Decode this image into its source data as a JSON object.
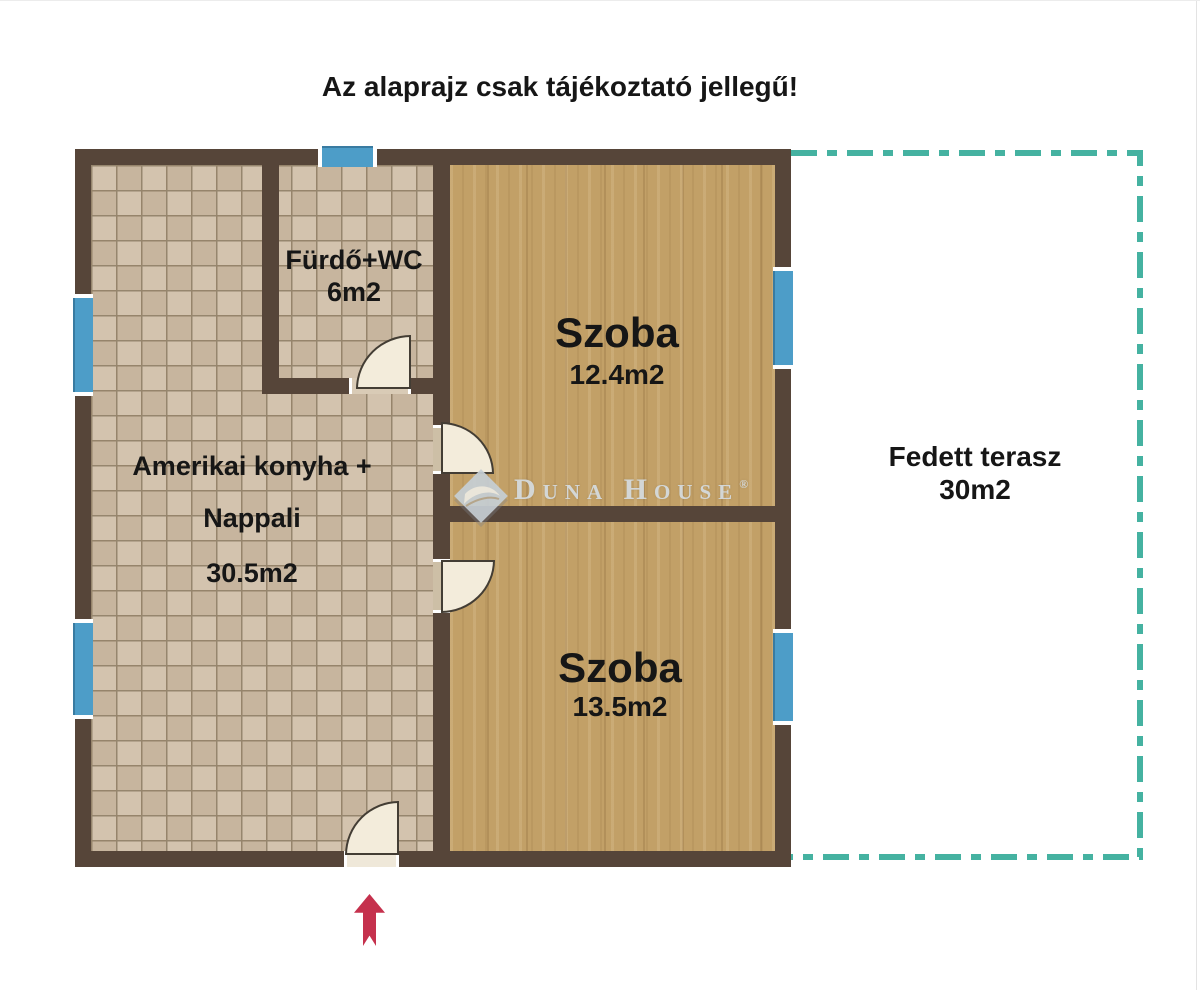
{
  "title": "Az alaprajz csak tájékoztató jellegű!",
  "rooms": {
    "bathroom": {
      "name": "Fürdő+WC",
      "area": "6m2"
    },
    "bedroom1": {
      "name": "Szoba",
      "area": "12.4m2"
    },
    "living": {
      "name_line1": "Amerikai konyha +",
      "name_line2": "Nappali",
      "area": "30.5m2"
    },
    "bedroom2": {
      "name": "Szoba",
      "area": "13.5m2"
    },
    "terrace": {
      "name": "Fedett terasz",
      "area": "30m2"
    }
  },
  "watermark": {
    "brand": "Duna House",
    "registered": "®"
  },
  "colors": {
    "wall": "#564539",
    "window": "#4d9dc8",
    "terrace_dash": "#45b2a1",
    "entry_arrow": "#c5314d",
    "tile_floor": "#d3c3ae",
    "wood_floor": "#c2a067",
    "door_leaf": "#f3ecdb"
  }
}
